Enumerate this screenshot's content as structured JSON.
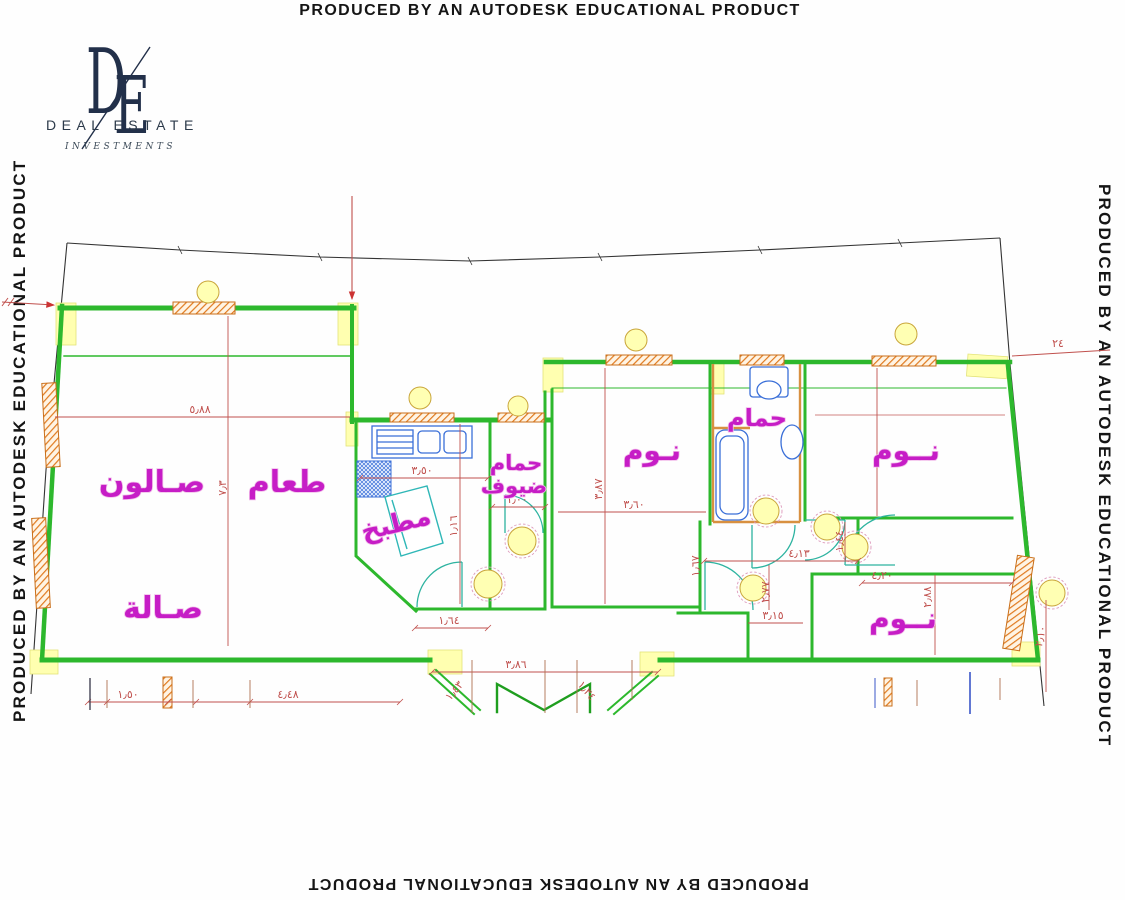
{
  "watermark": {
    "text": "PRODUCED BY AN AUTODESK EDUCATIONAL PRODUCT"
  },
  "logo": {
    "monogram_left": "D",
    "monogram_right": "E",
    "name": "DEAL ESTATE",
    "subtitle": "INVESTMENTS"
  },
  "colors": {
    "wall_green": "#2db82d",
    "dimension_red": "#c0504d",
    "label_magenta": "#c61dc6",
    "window_hatch_orange": "#e07a1f",
    "column_yellow": "#ffffb0",
    "fixture_blue": "#3a6fd8",
    "counter_cyan": "#2fb7b7",
    "boundary_black": "#333333",
    "light_yellow": "#ffffb3"
  },
  "rooms": [
    {
      "id": "salon",
      "label": "صـالون"
    },
    {
      "id": "dining",
      "label": "طعام"
    },
    {
      "id": "hall",
      "label": "صـالة"
    },
    {
      "id": "kitchen",
      "label": "مطبخ"
    },
    {
      "id": "guest-bath-line1",
      "label": "حمام"
    },
    {
      "id": "guest-bath-line2",
      "label": "ضيوف"
    },
    {
      "id": "bedroom-1",
      "label": "نـوم"
    },
    {
      "id": "bathroom",
      "label": "حمام"
    },
    {
      "id": "bedroom-2",
      "label": "نــوم"
    },
    {
      "id": "bedroom-3",
      "label": "نــوم"
    }
  ],
  "dimensions": [
    {
      "id": "salon-width",
      "value": "٥٫٨٨"
    },
    {
      "id": "salon-depth",
      "value": "٧٫٣"
    },
    {
      "id": "kitchen-width",
      "value": "٣٫٥٠"
    },
    {
      "id": "guest-bath-door",
      "value": "١٫٠٠"
    },
    {
      "id": "kitchen-right",
      "value": "١٫١٦"
    },
    {
      "id": "kitchen-bottom",
      "value": "١٫٦٤"
    },
    {
      "id": "bedroom1-depth",
      "value": "٣٫٨٧"
    },
    {
      "id": "bedroom1-width",
      "value": "٣٫٦٠"
    },
    {
      "id": "entrance-width",
      "value": "٣٫٨٦"
    },
    {
      "id": "plot-bottom-a",
      "value": "١٫٥٠"
    },
    {
      "id": "plot-bottom-b",
      "value": "٤٫٤٨"
    },
    {
      "id": "entrance-splay-left",
      "value": "١٫٤٣"
    },
    {
      "id": "entrance-splay-right",
      "value": "١٫٣٤"
    },
    {
      "id": "corridor-width",
      "value": "٤٫١٣"
    },
    {
      "id": "corridor-depth",
      "value": "٢٫٧٧"
    },
    {
      "id": "corridor-bottom",
      "value": "٣٫١٥"
    },
    {
      "id": "corridor-left",
      "value": "١٫٦٧"
    },
    {
      "id": "bedroom3-door",
      "value": "١٫٤٤"
    },
    {
      "id": "bedroom3-width",
      "value": "٤٫٢٠"
    },
    {
      "id": "bedroom3-depth",
      "value": "٢٫٨٨"
    },
    {
      "id": "right-wall",
      "value": "٢٫١٠"
    },
    {
      "id": "boundary-leader",
      "value": "٢٤"
    }
  ]
}
